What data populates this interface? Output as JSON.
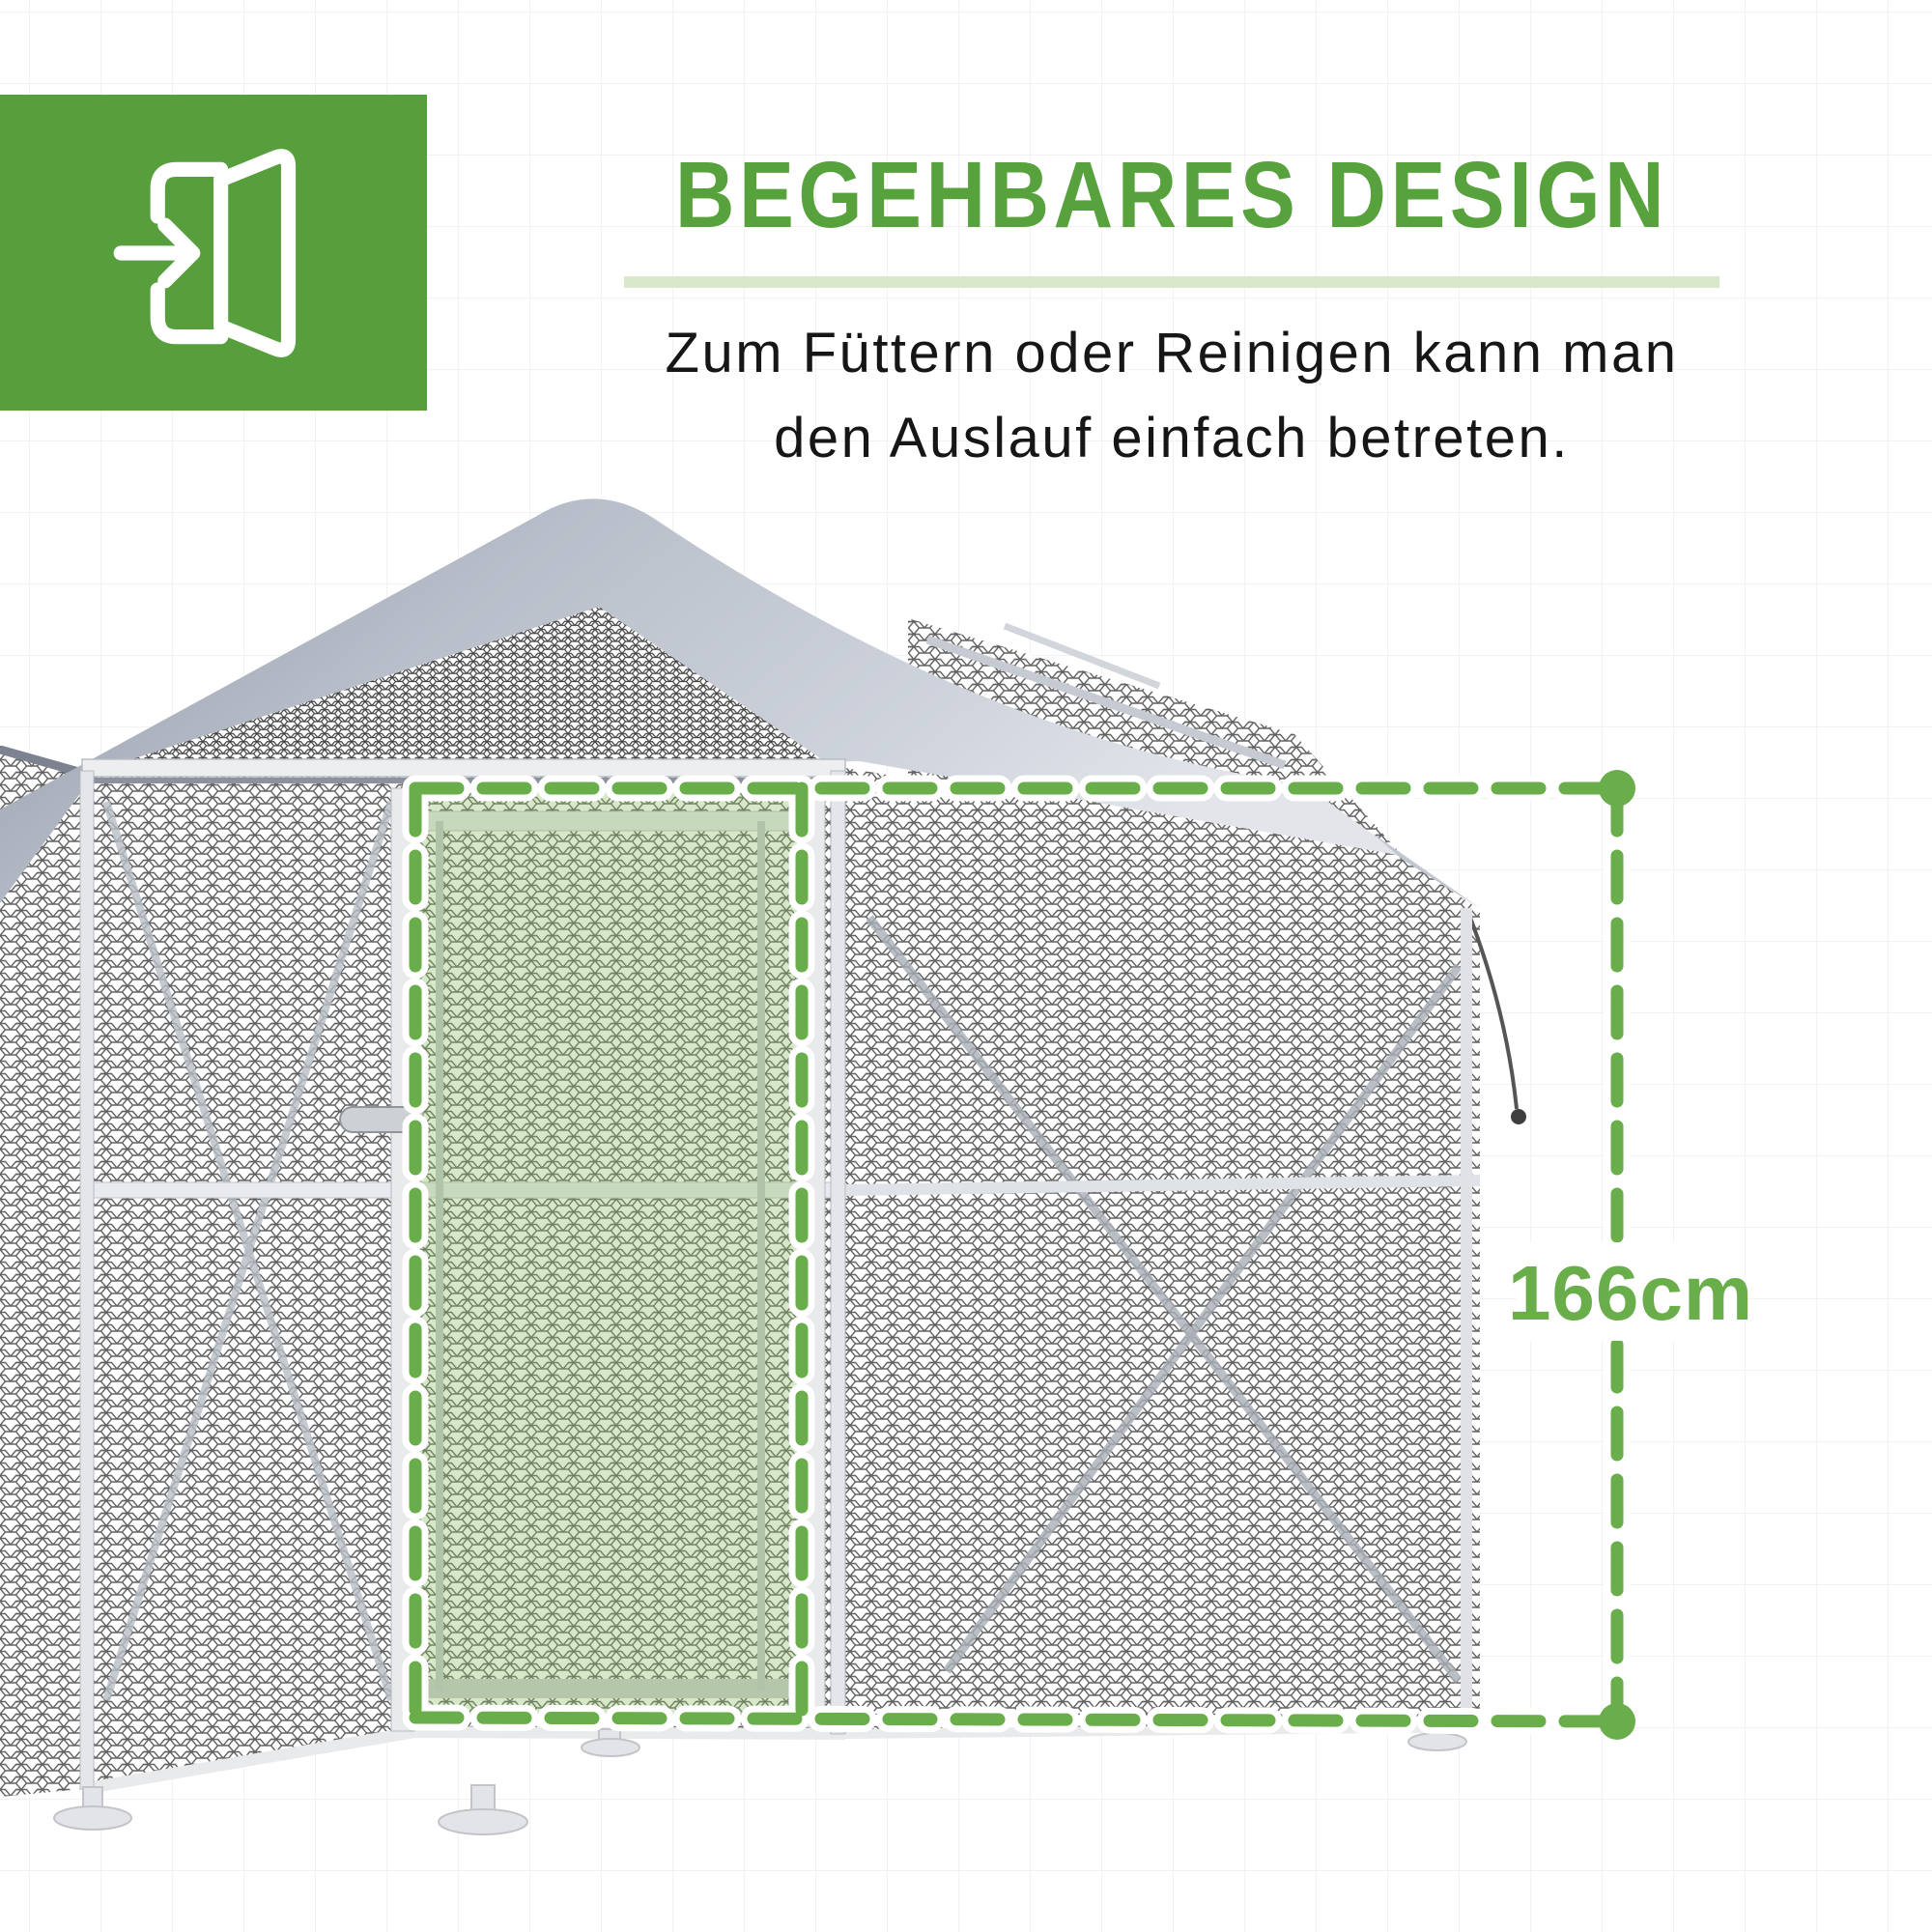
{
  "header": {
    "icon": "enter-door-icon",
    "icon_box_color": "#579e3c",
    "title": "BEGEHBARES DESIGN",
    "title_color": "#58a23e",
    "underline_color": "#d9e8ca",
    "subtitle_line1": "Zum Füttern oder Reinigen kann man",
    "subtitle_line2": "den Auslauf einfach betreten."
  },
  "annotation": {
    "measurement_label": "166cm",
    "dash_color": "#6aae4b",
    "dot_color": "#6aae4b",
    "door_highlight_fill": "#8fc06a"
  },
  "scene": {
    "subject": "walk-in-chicken-run-with-mesh-walls-and-tarp-roof",
    "roof_color": "#b9bfca",
    "mesh_line_color": "#3a3a3a",
    "frame_color": "#e4e6e9"
  }
}
